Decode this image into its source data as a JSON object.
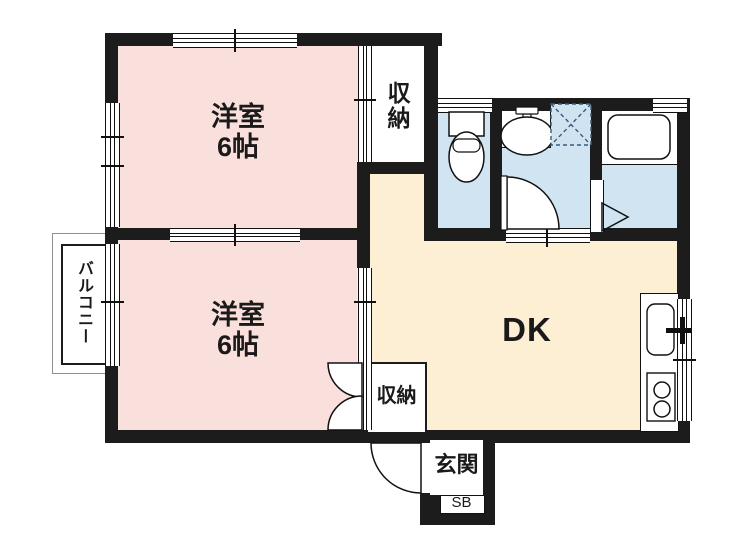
{
  "rooms": {
    "bedroom_top": {
      "name": "洋室",
      "size": "6帖"
    },
    "bedroom_bottom": {
      "name": "洋室",
      "size": "6帖"
    },
    "dining_kitchen": {
      "label": "DK"
    },
    "closet_top": {
      "label": "収納"
    },
    "closet_bottom": {
      "label": "収納"
    },
    "balcony": {
      "label": "バルコニー"
    },
    "entrance": {
      "label": "玄関"
    },
    "shoe_box": {
      "label": "SB"
    }
  },
  "colors": {
    "bedroom": "#f9e0dc",
    "dining_kitchen": "#fcefd4",
    "sanitary": "#d0e4f2",
    "wall": "#1c1c1c",
    "balcony_outline": "#909090"
  }
}
